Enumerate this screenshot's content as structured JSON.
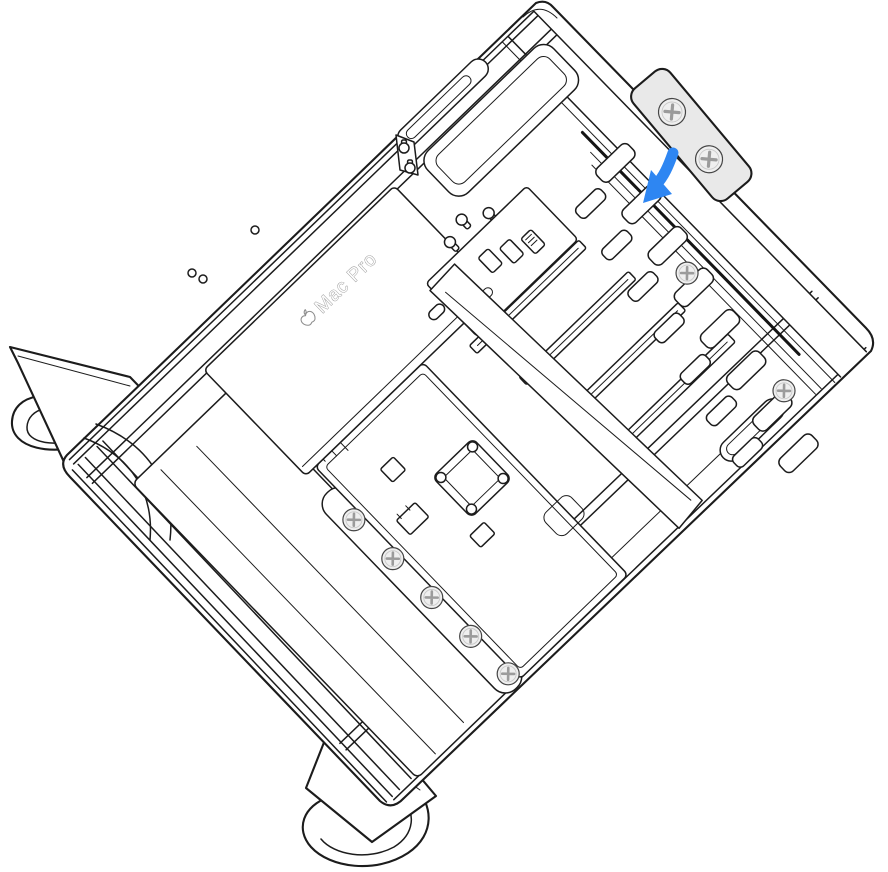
{
  "figure": {
    "type": "technical-illustration",
    "description": "Line illustration of a Mac Pro turned on its side with the housing removed, showing internal components. A blue arrow points to the PCIe bracket position at the edge of the enclosure, and the removed bracket with two screws is shown lifted away above it.",
    "device_label": "Mac Pro"
  },
  "colors": {
    "line": "#1c1c1c",
    "background": "#ffffff",
    "arrow_blue": "#2e86f2",
    "bracket_fill": "#e9e9e9",
    "screw_fill": "#efefef",
    "screw_cross": "#9b9b9b",
    "label_gray": "#8d8d8d"
  }
}
